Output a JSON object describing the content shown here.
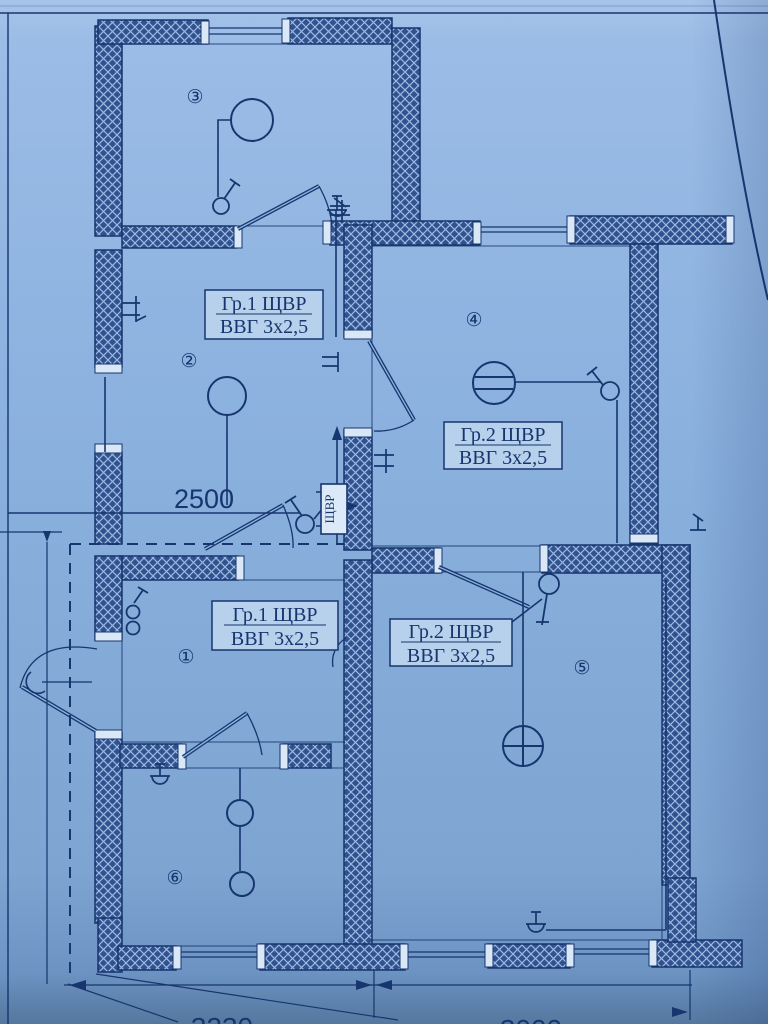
{
  "drawing_type": "electrical-floor-plan",
  "colors": {
    "paper": "#8ab0de",
    "paper_top": "#a6c4ea",
    "paper_bottom": "#55779f",
    "ink": "#17356e",
    "wall_fill": "#30528e",
    "wall_hatch": "#9db9e2",
    "cap_fill": "#d9e7f7",
    "label_box_fill": "#b7d0ec"
  },
  "labels": {
    "box_room2": {
      "line1": "Гр.1 ЩВР",
      "line2": "ВВГ 3х2,5"
    },
    "box_room4": {
      "line1": "Гр.2 ЩВР",
      "line2": "ВВГ 3х2,5"
    },
    "box_room1": {
      "line1": "Гр.1 ЩВР",
      "line2": "ВВГ 3х2,5"
    },
    "box_room5": {
      "line1": "Гр.2 ЩВР",
      "line2": "ВВГ 3х2,5"
    },
    "panel": "ЩВР"
  },
  "rooms": {
    "room1": "①",
    "room2": "②",
    "room3": "③",
    "room4": "④",
    "room5": "⑤",
    "room6": "⑥"
  },
  "dimensions": {
    "corridor": "2500",
    "bottom_left": "3230",
    "bottom_right": "3000"
  },
  "symbols": [
    "ceiling-lamp",
    "chandelier",
    "wall-sconce",
    "single-pole-switch",
    "double-switch",
    "socket-outlet",
    "distribution-board",
    "door-swing",
    "window",
    "hatched-wall",
    "dashed-boundary",
    "dimension-line"
  ]
}
